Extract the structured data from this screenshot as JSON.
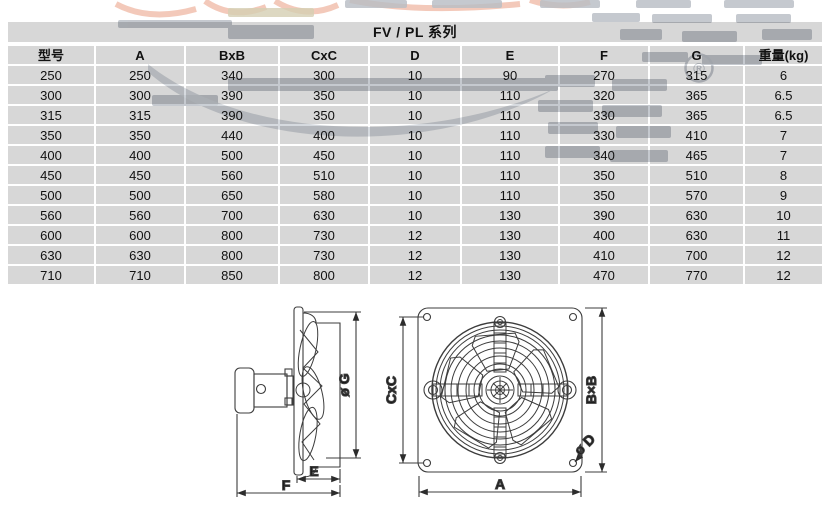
{
  "title": "FV / PL 系列",
  "registered_symbol": "®",
  "table": {
    "headers": [
      "型号",
      "A",
      "BxB",
      "CxC",
      "D",
      "E",
      "F",
      "G",
      "重量(kg)"
    ],
    "rows": [
      [
        "250",
        "250",
        "340",
        "300",
        "10",
        "90",
        "270",
        "315",
        "6"
      ],
      [
        "300",
        "300",
        "390",
        "350",
        "10",
        "110",
        "320",
        "365",
        "6.5"
      ],
      [
        "315",
        "315",
        "390",
        "350",
        "10",
        "110",
        "330",
        "365",
        "6.5"
      ],
      [
        "350",
        "350",
        "440",
        "400",
        "10",
        "110",
        "330",
        "410",
        "7"
      ],
      [
        "400",
        "400",
        "500",
        "450",
        "10",
        "110",
        "340",
        "465",
        "7"
      ],
      [
        "450",
        "450",
        "560",
        "510",
        "10",
        "110",
        "350",
        "510",
        "8"
      ],
      [
        "500",
        "500",
        "650",
        "580",
        "10",
        "110",
        "350",
        "570",
        "9"
      ],
      [
        "560",
        "560",
        "700",
        "630",
        "10",
        "130",
        "390",
        "630",
        "10"
      ],
      [
        "600",
        "600",
        "800",
        "730",
        "12",
        "130",
        "400",
        "630",
        "11"
      ],
      [
        "630",
        "630",
        "800",
        "730",
        "12",
        "130",
        "410",
        "700",
        "12"
      ],
      [
        "710",
        "710",
        "850",
        "800",
        "12",
        "130",
        "470",
        "770",
        "12"
      ]
    ]
  },
  "diagram_labels": {
    "side_view": {
      "fan_diameter": "ø G",
      "inner_depth": "E",
      "total_depth": "F"
    },
    "front_view": {
      "hole_pitch": "CxC",
      "plate_size": "B×B",
      "plate_width": "A",
      "hole_diameter": "ø D"
    }
  },
  "colors": {
    "row_background": "#d8d8d8",
    "text": "#111111",
    "drawing_line": "#3c3c3c",
    "watermark_gray": "#aab1ba",
    "watermark_salmon": "#ecab93"
  }
}
